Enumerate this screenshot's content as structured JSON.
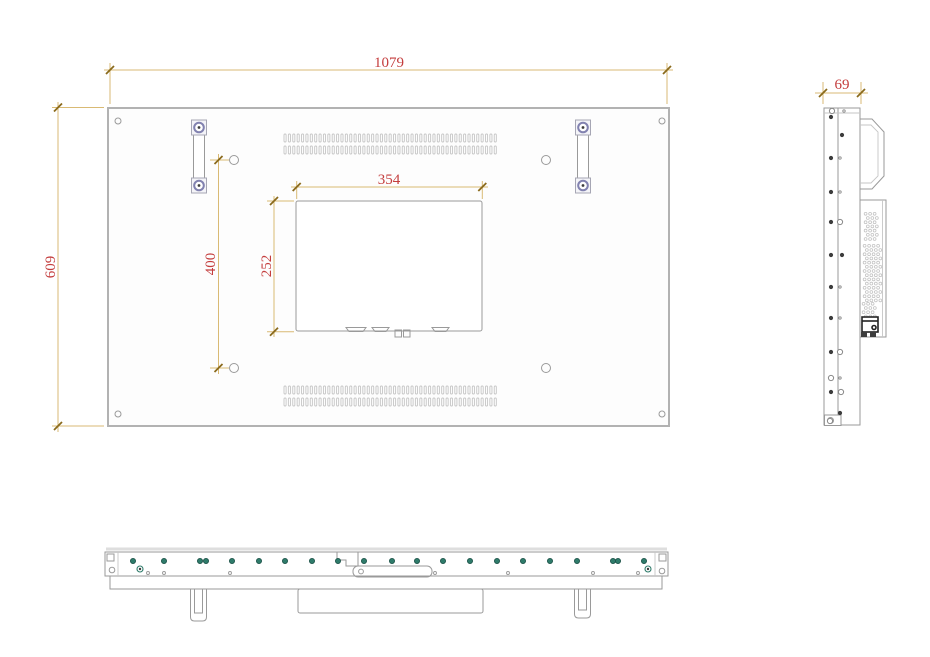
{
  "drawing": {
    "title": "display-panel-technical-drawing",
    "dimensions": {
      "rear_width": "1079",
      "rear_height": "609",
      "vesa_plate_width": "354",
      "vesa_plate_height": "252",
      "vesa_hole_pitch_vertical": "400",
      "side_depth": "69"
    },
    "colors": {
      "dimension_line": "#d9ba74",
      "dimension_tick": "#8a6a1c",
      "dimension_text": "#c43d3d",
      "outline_main": "#b2b2b2",
      "outline_detail": "#9a9a9a",
      "outline_light": "#c6c6c6",
      "handle_ring": "#8282b0",
      "screw_teal": "#2e7b6a",
      "screw_dark": "#3c3c3c"
    },
    "rear_view": {
      "vent_slots_per_row": 49,
      "vent_row_y": [
        134,
        146,
        386,
        398
      ]
    },
    "side_view": {
      "screws": [
        [
          832,
          111,
          "c"
        ],
        [
          844,
          111,
          "o"
        ],
        [
          831,
          117,
          "d"
        ],
        [
          842,
          135,
          "d"
        ],
        [
          831,
          158,
          "d"
        ],
        [
          840,
          158,
          "o"
        ],
        [
          831,
          192,
          "d"
        ],
        [
          840,
          192,
          "o"
        ],
        [
          831,
          222,
          "d"
        ],
        [
          840,
          222,
          "c"
        ],
        [
          831,
          255,
          "d"
        ],
        [
          842,
          255,
          "d"
        ],
        [
          831,
          287,
          "d"
        ],
        [
          840,
          287,
          "o"
        ],
        [
          831,
          318,
          "d"
        ],
        [
          840,
          318,
          "o"
        ],
        [
          831,
          352,
          "d"
        ],
        [
          840,
          352,
          "c"
        ],
        [
          831,
          378,
          "c"
        ],
        [
          840,
          378,
          "o"
        ],
        [
          831,
          392,
          "d"
        ],
        [
          841,
          392,
          "c"
        ],
        [
          840,
          413,
          "d"
        ],
        [
          830,
          421,
          "c"
        ]
      ]
    },
    "bottom_view": {
      "screw_dots_x": [
        133,
        164,
        200,
        206,
        232,
        259,
        285,
        312,
        338,
        364,
        392,
        417,
        443,
        470,
        497,
        523,
        550,
        577,
        613,
        618,
        644
      ],
      "pilot_holes_x": [
        148,
        164,
        230,
        435,
        508,
        593,
        638
      ],
      "ring_screws": [
        [
          140,
          569
        ],
        [
          648,
          569
        ]
      ]
    }
  }
}
